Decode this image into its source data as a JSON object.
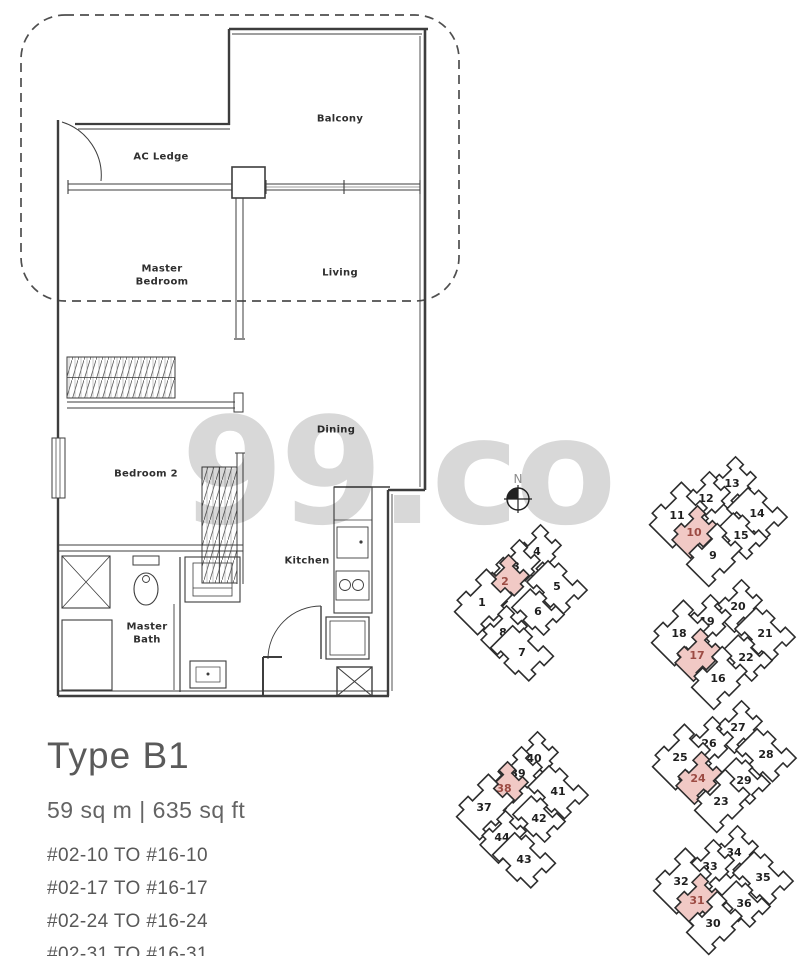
{
  "watermark": {
    "text": "99.co",
    "color": "#d8d8d8"
  },
  "plan": {
    "room_labels": {
      "balcony": "Balcony",
      "ac_ledge": "AC Ledge",
      "master_bedroom": "Master Bedroom",
      "living": "Living",
      "dining": "Dining",
      "bedroom2": "Bedroom 2",
      "kitchen": "Kitchen",
      "master_bath": "Master Bath"
    }
  },
  "info": {
    "type_title": "Type B1",
    "area": "59 sq m  |  635 sq ft",
    "stacks": [
      "#02-10 TO #16-10",
      "#02-17 TO #16-17",
      "#02-24 TO #16-24",
      "#02-31 TO #16-31"
    ]
  },
  "site_map": {
    "north_label": "N",
    "colors": {
      "unit_fill": "#ffffff",
      "unit_outline": "#2d2d2d",
      "unit_text": "#1f1f1f",
      "highlight_fill": "#f1c9c5",
      "highlight_text": "#9c4b43"
    },
    "clusters": [
      {
        "name": "stacks-1-8",
        "units": [
          {
            "n": "4",
            "x": 537,
            "y": 551,
            "r": -45,
            "s": 1,
            "h": false
          },
          {
            "n": "3",
            "x": 516,
            "y": 566,
            "r": -45,
            "s": 1,
            "h": false
          },
          {
            "n": "5",
            "x": 557,
            "y": 586,
            "r": 45,
            "s": 1.15,
            "h": false
          },
          {
            "n": "2",
            "x": 505,
            "y": 581,
            "r": -45,
            "s": 1,
            "h": true
          },
          {
            "n": "1",
            "x": 482,
            "y": 602,
            "r": -45,
            "s": 1.25,
            "h": false
          },
          {
            "n": "6",
            "x": 538,
            "y": 611,
            "r": 45,
            "s": 1,
            "h": false
          },
          {
            "n": "8",
            "x": 503,
            "y": 632,
            "r": -45,
            "s": 1,
            "h": false
          },
          {
            "n": "7",
            "x": 522,
            "y": 652,
            "r": 45,
            "s": 1.2,
            "h": false
          }
        ]
      },
      {
        "name": "stacks-9-15",
        "units": [
          {
            "n": "13",
            "x": 732,
            "y": 483,
            "r": -45,
            "s": 1,
            "h": false
          },
          {
            "n": "12",
            "x": 706,
            "y": 498,
            "r": -45,
            "s": 1,
            "h": false
          },
          {
            "n": "11",
            "x": 677,
            "y": 515,
            "r": -45,
            "s": 1.25,
            "h": false
          },
          {
            "n": "14",
            "x": 757,
            "y": 513,
            "r": 45,
            "s": 1.15,
            "h": false
          },
          {
            "n": "15",
            "x": 741,
            "y": 535,
            "r": 45,
            "s": 1,
            "h": false
          },
          {
            "n": "10",
            "x": 694,
            "y": 532,
            "r": -45,
            "s": 1,
            "h": true
          },
          {
            "n": "9",
            "x": 713,
            "y": 555,
            "r": -45,
            "s": 1.2,
            "h": false
          }
        ]
      },
      {
        "name": "stacks-16-22",
        "units": [
          {
            "n": "20",
            "x": 738,
            "y": 606,
            "r": -45,
            "s": 1,
            "h": false
          },
          {
            "n": "19",
            "x": 707,
            "y": 621,
            "r": -45,
            "s": 1,
            "h": false
          },
          {
            "n": "18",
            "x": 679,
            "y": 633,
            "r": -45,
            "s": 1.25,
            "h": false
          },
          {
            "n": "21",
            "x": 765,
            "y": 633,
            "r": 45,
            "s": 1.15,
            "h": false
          },
          {
            "n": "22",
            "x": 746,
            "y": 657,
            "r": 45,
            "s": 1,
            "h": false
          },
          {
            "n": "17",
            "x": 697,
            "y": 655,
            "r": -45,
            "s": 1,
            "h": true
          },
          {
            "n": "16",
            "x": 718,
            "y": 678,
            "r": -45,
            "s": 1.2,
            "h": false
          }
        ]
      },
      {
        "name": "stacks-23-29",
        "units": [
          {
            "n": "27",
            "x": 738,
            "y": 727,
            "r": -45,
            "s": 1,
            "h": false
          },
          {
            "n": "26",
            "x": 709,
            "y": 743,
            "r": -45,
            "s": 1,
            "h": false
          },
          {
            "n": "25",
            "x": 680,
            "y": 757,
            "r": -45,
            "s": 1.25,
            "h": false
          },
          {
            "n": "28",
            "x": 766,
            "y": 754,
            "r": 45,
            "s": 1.15,
            "h": false
          },
          {
            "n": "29",
            "x": 744,
            "y": 780,
            "r": 45,
            "s": 1,
            "h": false
          },
          {
            "n": "24",
            "x": 698,
            "y": 778,
            "r": -45,
            "s": 1,
            "h": true
          },
          {
            "n": "23",
            "x": 721,
            "y": 801,
            "r": -45,
            "s": 1.2,
            "h": false
          }
        ]
      },
      {
        "name": "stacks-30-36",
        "units": [
          {
            "n": "34",
            "x": 734,
            "y": 852,
            "r": -45,
            "s": 1,
            "h": false
          },
          {
            "n": "33",
            "x": 710,
            "y": 866,
            "r": -45,
            "s": 1,
            "h": false
          },
          {
            "n": "32",
            "x": 681,
            "y": 881,
            "r": -45,
            "s": 1.25,
            "h": false
          },
          {
            "n": "35",
            "x": 763,
            "y": 877,
            "r": 45,
            "s": 1.15,
            "h": false
          },
          {
            "n": "36",
            "x": 744,
            "y": 903,
            "r": 45,
            "s": 1,
            "h": false
          },
          {
            "n": "31",
            "x": 697,
            "y": 900,
            "r": -45,
            "s": 1,
            "h": true
          },
          {
            "n": "30",
            "x": 713,
            "y": 923,
            "r": -45,
            "s": 1.2,
            "h": false
          }
        ]
      },
      {
        "name": "stacks-37-44",
        "units": [
          {
            "n": "40",
            "x": 534,
            "y": 758,
            "r": -45,
            "s": 1,
            "h": false
          },
          {
            "n": "39",
            "x": 518,
            "y": 773,
            "r": -45,
            "s": 1,
            "h": false
          },
          {
            "n": "41",
            "x": 558,
            "y": 791,
            "r": 45,
            "s": 1.15,
            "h": false
          },
          {
            "n": "38",
            "x": 504,
            "y": 788,
            "r": -45,
            "s": 1,
            "h": true
          },
          {
            "n": "37",
            "x": 484,
            "y": 807,
            "r": -45,
            "s": 1.25,
            "h": false
          },
          {
            "n": "42",
            "x": 539,
            "y": 818,
            "r": 45,
            "s": 1,
            "h": false
          },
          {
            "n": "44",
            "x": 502,
            "y": 837,
            "r": -45,
            "s": 1,
            "h": false
          },
          {
            "n": "43",
            "x": 524,
            "y": 859,
            "r": 45,
            "s": 1.2,
            "h": false
          }
        ]
      }
    ]
  }
}
